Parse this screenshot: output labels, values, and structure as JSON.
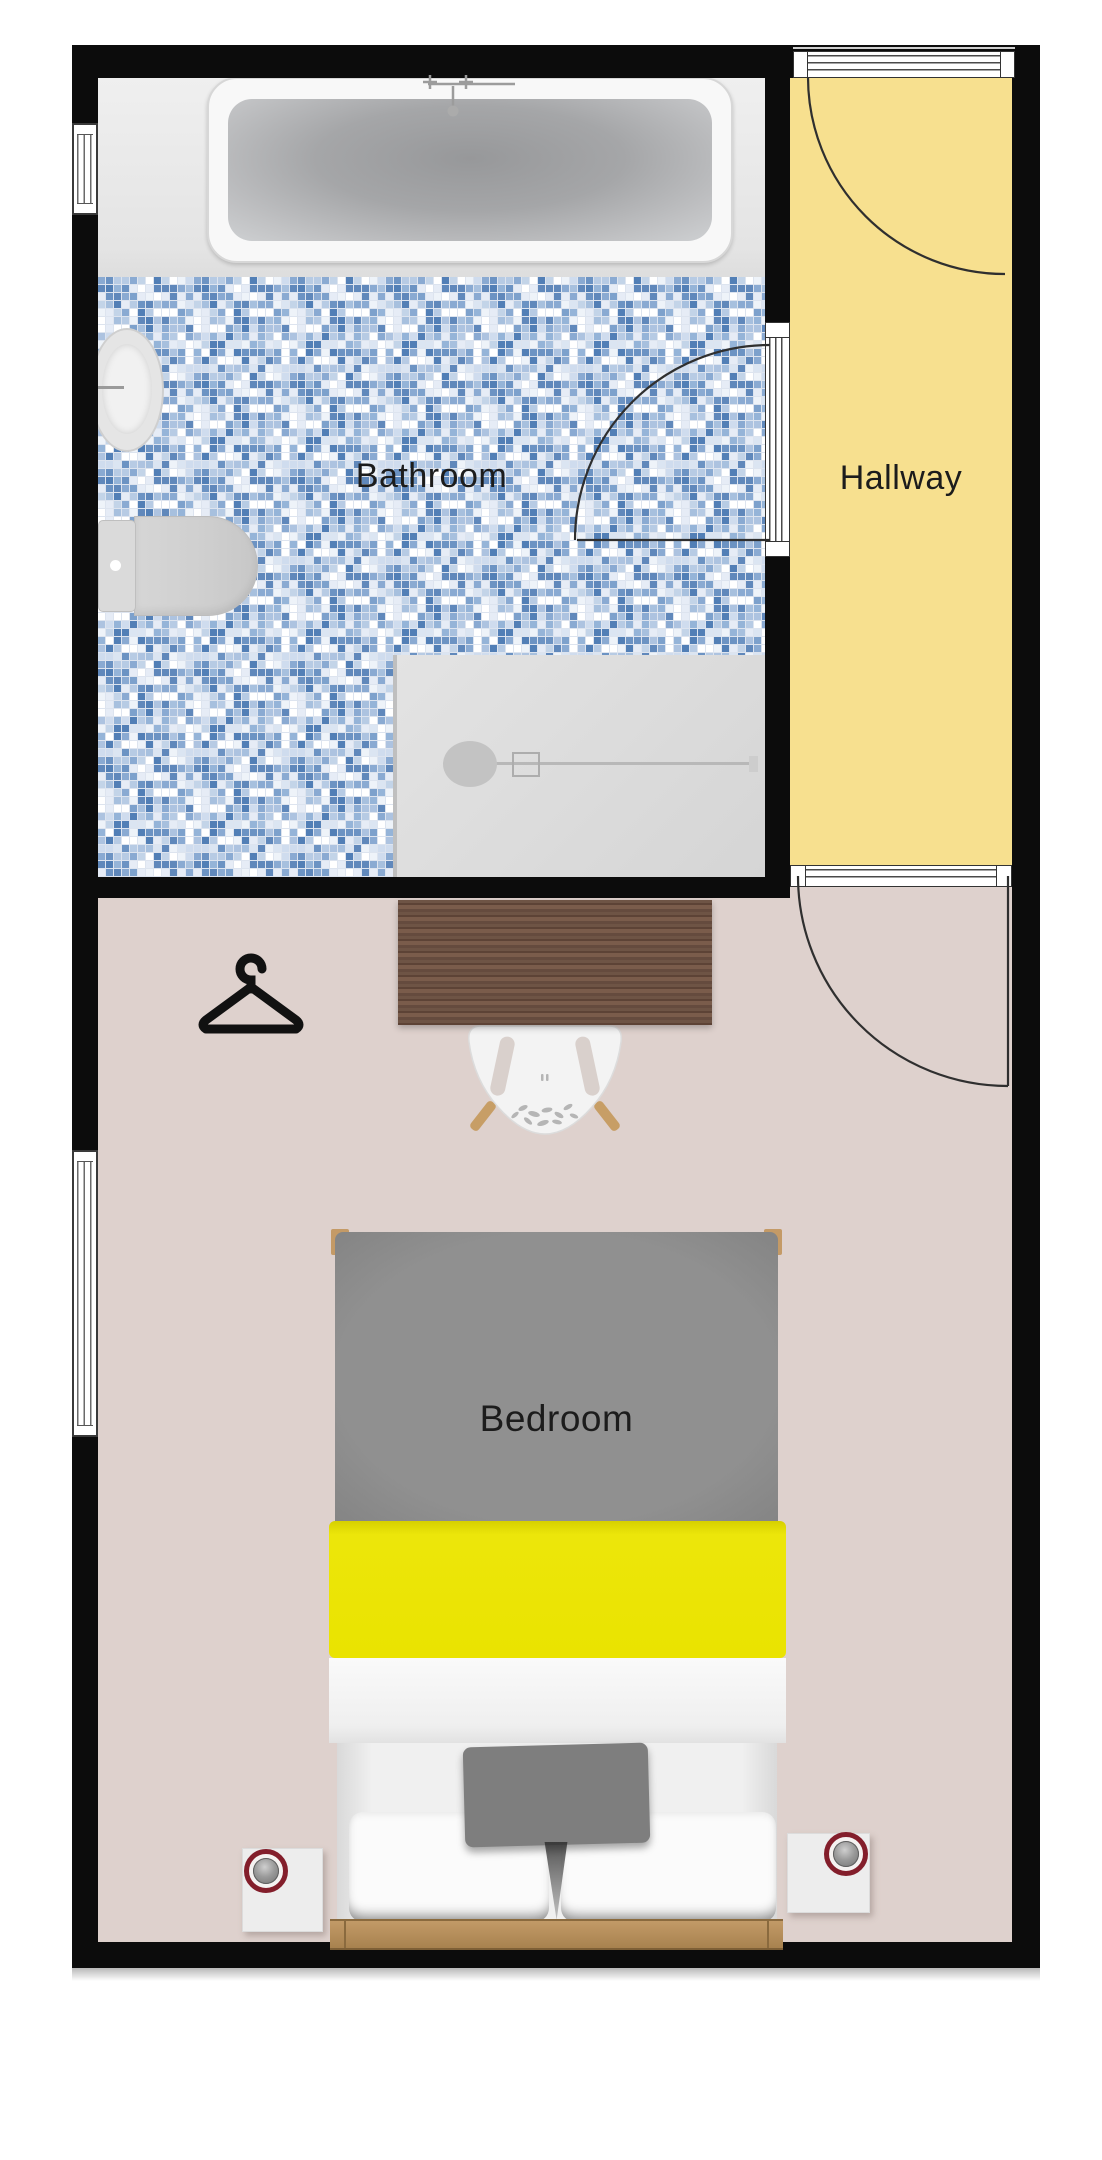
{
  "plan_title": "Apartment floor plan",
  "rooms": [
    {
      "id": "bathroom",
      "label": "Bathroom"
    },
    {
      "id": "hallway",
      "label": "Hallway"
    },
    {
      "id": "bedroom",
      "label": "Bedroom"
    }
  ],
  "icons": {
    "hanger": "clothes-hanger-icon",
    "lamp_left": "table-lamp-icon",
    "lamp_right": "table-lamp-icon"
  },
  "colors": {
    "wall": "#0c0c0c",
    "hallway_floor": "#F7E08F",
    "bedroom_floor": "#DED1CD",
    "bath_platform": "#E9E9E9",
    "tile_grout": "#dde4ef",
    "bed_gray": "#8B8B8B",
    "bed_yellow": "#EAE304",
    "bed_white": "#F5F5F5",
    "wood_frame": "#BB9160",
    "wood_desk": "#6A5042",
    "chair_white": "#F3F3F3",
    "lamp_red": "#831E2B",
    "tray_gray": "#DCDCDC",
    "fixture_gray": "#D6D6D6",
    "tile_blues": [
      "#ffffff",
      "#eef3f9",
      "#dbe5f2",
      "#c3d4e8",
      "#a7c0de",
      "#8aaad2",
      "#6c93c3",
      "#527fb6",
      "#b7cbe4",
      "#95b4d8",
      "#7da1cc",
      "#cfdcee",
      "#e6ecf6",
      "#ffffff",
      "#adc3e0",
      "#6088bb"
    ]
  }
}
